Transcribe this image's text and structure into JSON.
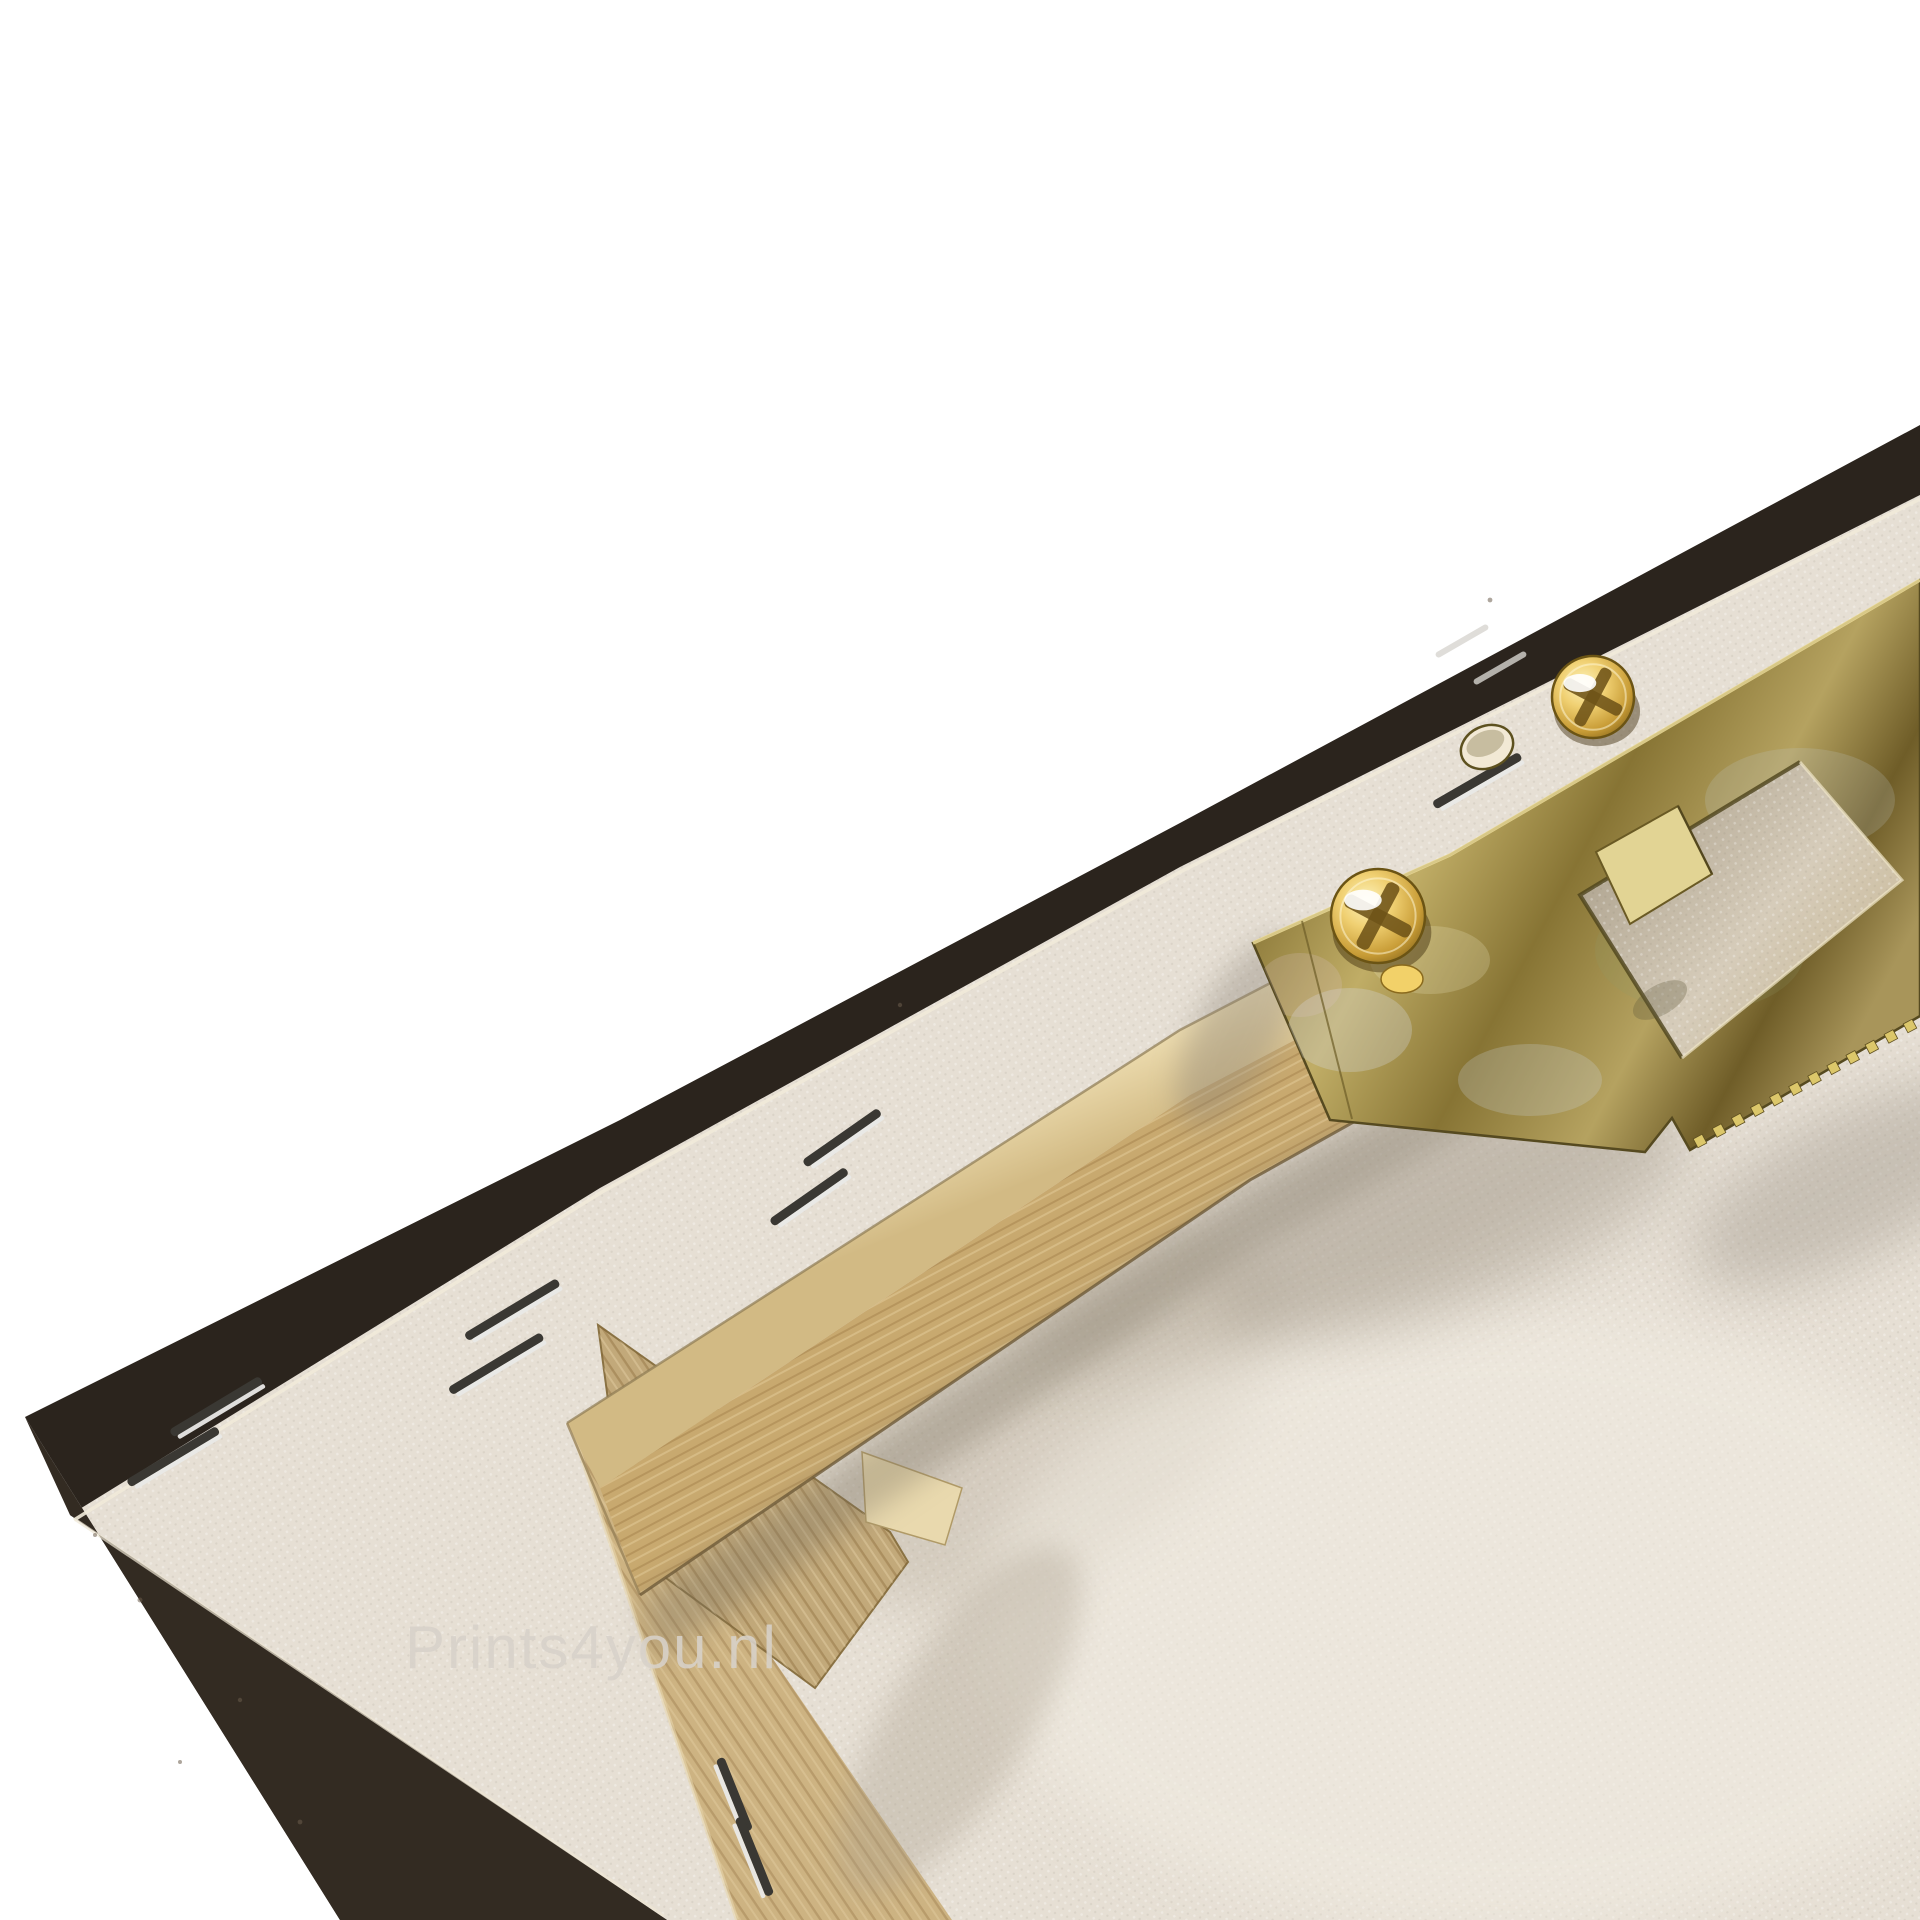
{
  "meta": {
    "type": "product-photo",
    "subject": "Back side of a stretched canvas print, corner view, with wooden stretcher frame, staples and sawtooth hanging bracket",
    "background_color": "#ffffff"
  },
  "watermark": {
    "text": "Prints4you.nl",
    "color": "#d8d2ca"
  },
  "palette": {
    "background": "#ffffff",
    "frame_edge_dark": "#2b241d",
    "frame_edge_light": "#332b22",
    "canvas_back": "#e6dfd4",
    "canvas_fold_highlight": "#f1ead9",
    "wood_bevel": "#e7d4a8",
    "wood_face": "#c8a96f",
    "wood_brace": "#c2a97a",
    "wood_end_grain": "#e9d9ae",
    "metal_gold": "#a18c48",
    "screw_brass": "#f0d072",
    "staple_dark": "#3a3833",
    "staple_silver": "#e9e9e7"
  },
  "parts": {
    "frame_edge": {
      "label": "dark printed canvas wrapped edge"
    },
    "canvas_back": {
      "label": "primed cotton canvas back"
    },
    "stretcher_bar": {
      "label": "pine stretcher bar with bevel"
    },
    "side_bar": {
      "label": "pine side stretcher bar"
    },
    "cross_brace": {
      "label": "pine cross brace end"
    },
    "hanger": {
      "label": "zinc sawtooth hanger bracket",
      "teeth_count": 12,
      "teeth_line": [
        1700,
        1141,
        1910,
        1026
      ]
    },
    "screws": [
      {
        "x": 1378,
        "y": 916,
        "r": 47,
        "drip": true,
        "label": "phillips screw left"
      },
      {
        "x": 1593,
        "y": 697,
        "r": 41,
        "drip": false,
        "label": "phillips screw right"
      }
    ],
    "pilot_hole": {
      "x": 1487,
      "y": 747,
      "label": "empty pilot hole"
    },
    "staples": [
      {
        "x": 843,
        "y": 1139,
        "len": 92,
        "angle": -35,
        "faint": false
      },
      {
        "x": 810,
        "y": 1198,
        "len": 92,
        "angle": -35,
        "faint": false
      },
      {
        "x": 217,
        "y": 1408,
        "len": 105,
        "angle": -31,
        "faint": false
      },
      {
        "x": 174,
        "y": 1458,
        "len": 105,
        "angle": -31,
        "faint": false
      },
      {
        "x": 513,
        "y": 1311,
        "len": 108,
        "angle": -31,
        "faint": false
      },
      {
        "x": 497,
        "y": 1365,
        "len": 108,
        "angle": -31,
        "faint": false
      },
      {
        "x": 1478,
        "y": 782,
        "len": 100,
        "angle": -30,
        "faint": false
      },
      {
        "x": 1462,
        "y": 641,
        "len": 60,
        "angle": -30,
        "faint": true
      },
      {
        "x": 1500,
        "y": 668,
        "len": 60,
        "angle": -30,
        "faint": true
      },
      {
        "x": 733,
        "y": 1795,
        "len": 78,
        "angle": 68,
        "faint": false
      },
      {
        "x": 753,
        "y": 1857,
        "len": 84,
        "angle": 68,
        "faint": false
      }
    ]
  }
}
